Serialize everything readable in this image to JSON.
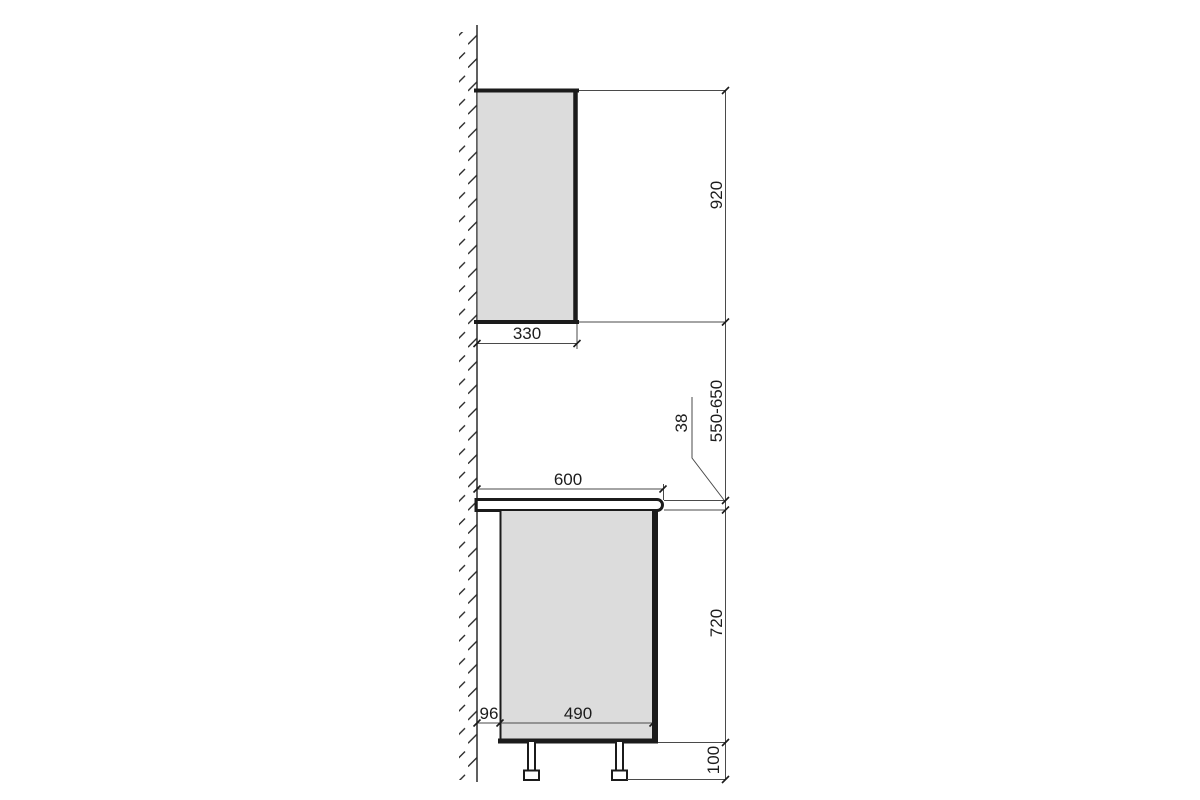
{
  "dims": {
    "wall_cabinet_height": "920",
    "wall_cabinet_depth": "330",
    "counter_to_wall_cabinet_gap": "550-650",
    "countertop_thickness": "38",
    "countertop_depth": "600",
    "base_cabinet_height": "720",
    "base_cabinet_depth": "490",
    "wall_clearance": "96",
    "leg_height": "100"
  },
  "colors": {
    "background": "#ffffff",
    "outline": "#1b1b1b",
    "dimension_line": "#4a4a4a",
    "text": "#1c1c1c",
    "cabinet_fill": "#dcdcdc",
    "countertop_fill": "#d8d8d8"
  }
}
